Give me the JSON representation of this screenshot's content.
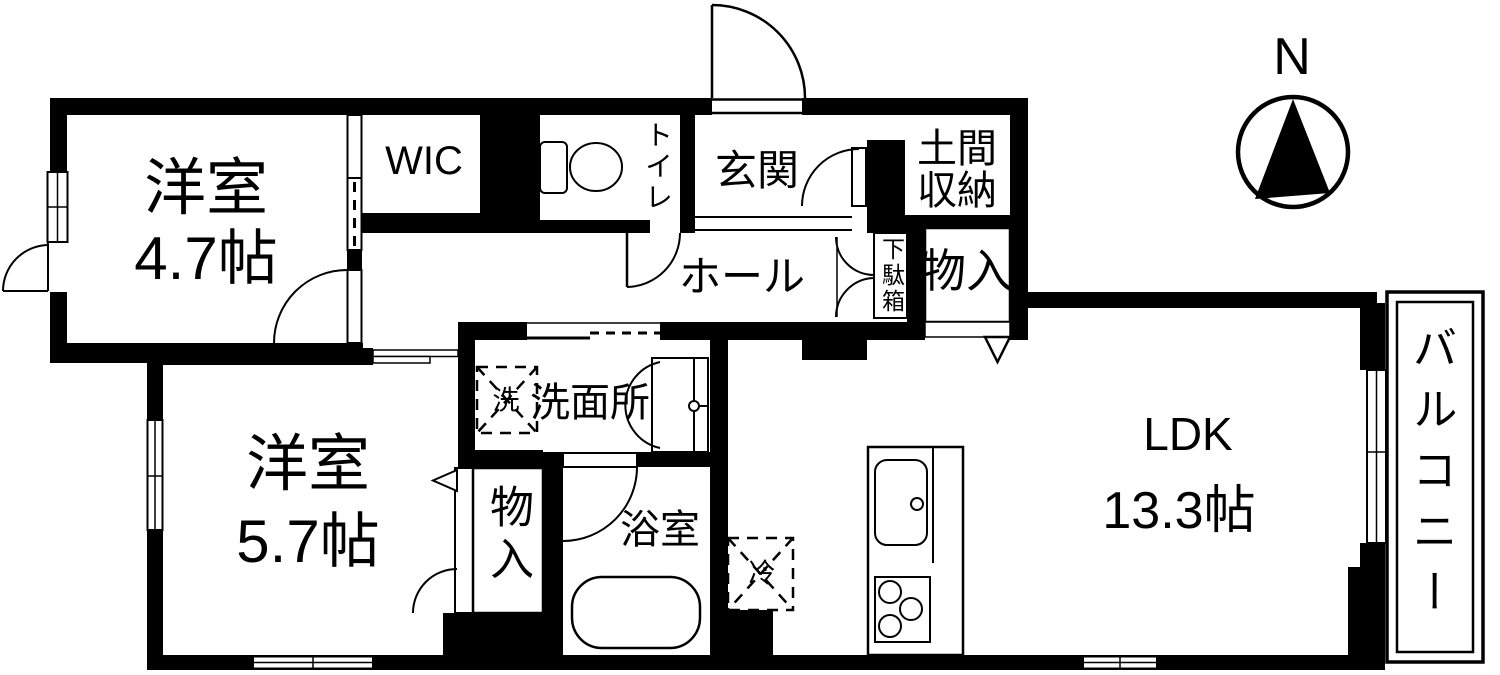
{
  "colors": {
    "wall": "#000000",
    "background": "#ffffff",
    "line": "#000000"
  },
  "compass": {
    "label": "N"
  },
  "rooms": {
    "bedroom1": {
      "name": "洋室",
      "area": "4.7帖"
    },
    "wic": {
      "name": "WIC"
    },
    "toilet": {
      "name": "トイレ"
    },
    "entrance": {
      "name": "玄関"
    },
    "doma_storage": {
      "line1": "土間",
      "line2": "収納"
    },
    "hall": {
      "name": "ホール"
    },
    "shoe_cabinet": {
      "name": "下駄箱"
    },
    "storage_upper": {
      "name": "物入"
    },
    "bedroom2": {
      "name": "洋室",
      "area": "5.7帖"
    },
    "storage_lower": {
      "name": "物入"
    },
    "washroom": {
      "name": "洗面所"
    },
    "bathroom": {
      "name": "浴室"
    },
    "ldk": {
      "name": "LDK",
      "area": "13.3帖"
    },
    "balcony": {
      "name": "バルコニー"
    }
  },
  "appliances": {
    "washer": "洗",
    "fridge": "冷"
  },
  "symbols": [
    "compass-icon",
    "toilet-icon",
    "washbasin-icon",
    "bathtub-icon",
    "kitchen-sink-icon",
    "stove-icon",
    "washer-box-icon",
    "fridge-box-icon",
    "door-arc-icon",
    "sliding-door-icon",
    "window-icon",
    "entry-triangle-icon"
  ]
}
